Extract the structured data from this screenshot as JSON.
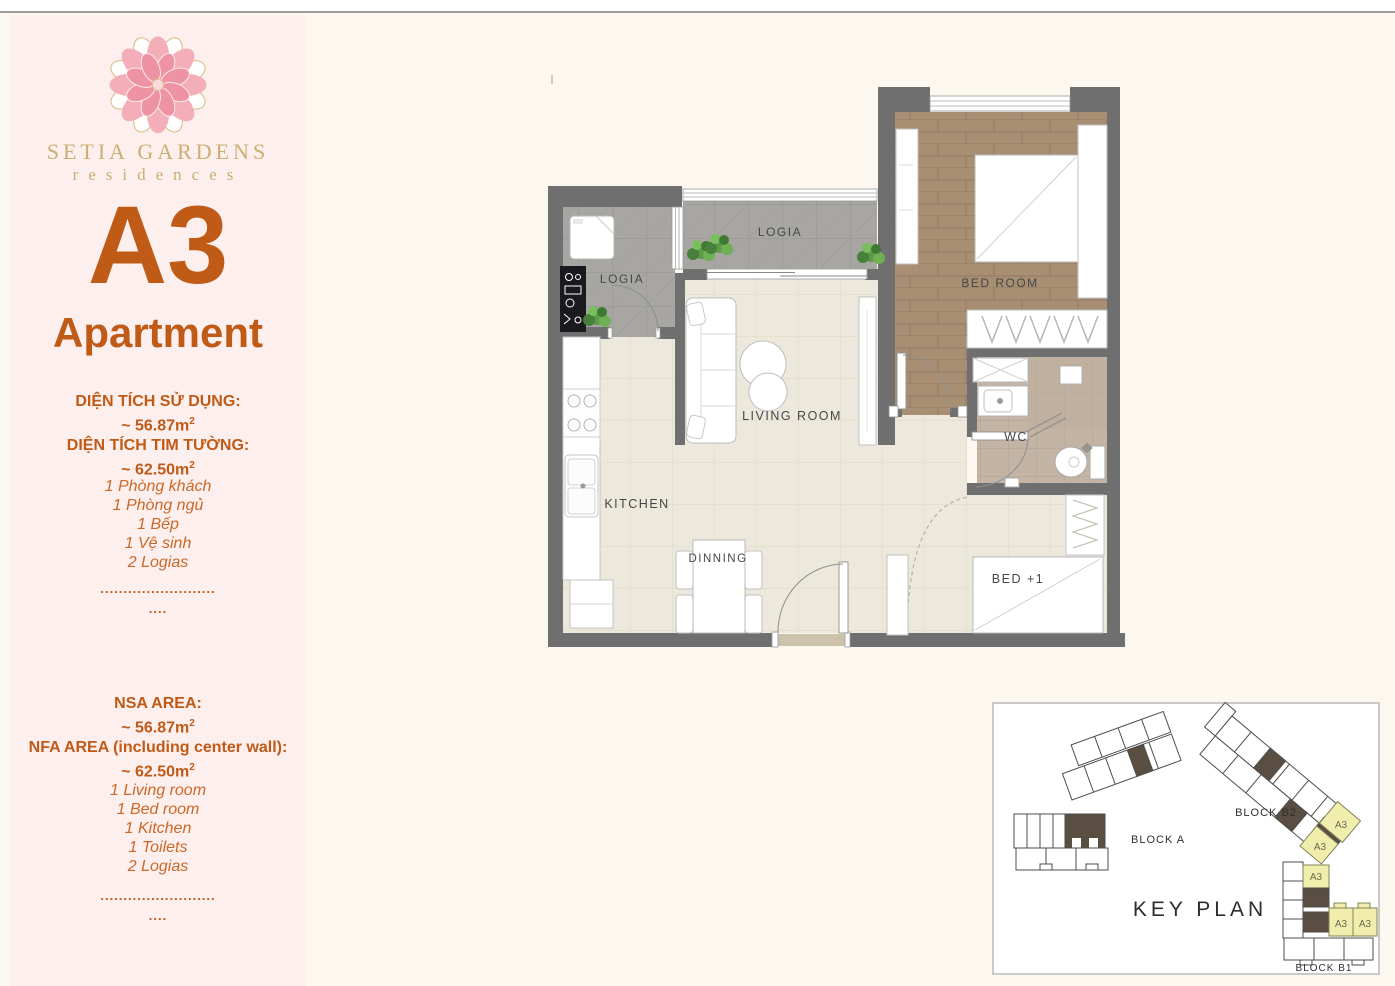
{
  "brand": {
    "name": "SETIA GARDENS",
    "sub": "residences"
  },
  "apartment": {
    "code": "A3",
    "label": "Apartment"
  },
  "areas_vn": {
    "heading1": "DIỆN TÍCH SỬ DỤNG:",
    "value1": "~ 56.87m",
    "heading2": "DIỆN TÍCH TIM TƯỜNG:",
    "value2": "~ 62.50m",
    "sup": "2",
    "items": [
      "1 Phòng khách",
      "1 Phòng ngủ",
      "1 Bếp",
      "1 Vệ sinh",
      "2 Logias"
    ],
    "divider_dots": ".........................",
    "divider_short": "...."
  },
  "areas_en": {
    "heading1": "NSA AREA:",
    "value1": "~ 56.87m",
    "heading2": "NFA AREA (including center wall):",
    "value2": "~ 62.50m",
    "sup": "2",
    "items": [
      "1 Living room",
      "1 Bed room",
      "1 Kitchen",
      "1 Toilets",
      "2 Logias"
    ],
    "divider_dots": ".........................",
    "divider_short": "...."
  },
  "floor_plan": {
    "labels": {
      "logia_top": "LOGIA",
      "logia_left": "LOGIA",
      "bedroom": "BED ROOM",
      "living_room": "LIVING ROOM",
      "kitchen": "KITCHEN",
      "dinning": "DINNING",
      "wc": "WC",
      "bed_plus_one": "BED +1"
    }
  },
  "key_plan": {
    "title": "KEY PLAN",
    "block_a": "BLOCK A",
    "block_b2": "BLOCK B2",
    "block_b1": "BLOCK B1",
    "unit_label": "A3",
    "highlight_color": "#f1eead"
  },
  "colors": {
    "accent_orange": "#c05a17",
    "brand_gold": "#cbae72",
    "sidebar_pink": "#fdefed",
    "page_cream": "#fcf8f0",
    "wall_gray": "#6f6f6f",
    "dark_unit_brown": "#5a4e43"
  }
}
